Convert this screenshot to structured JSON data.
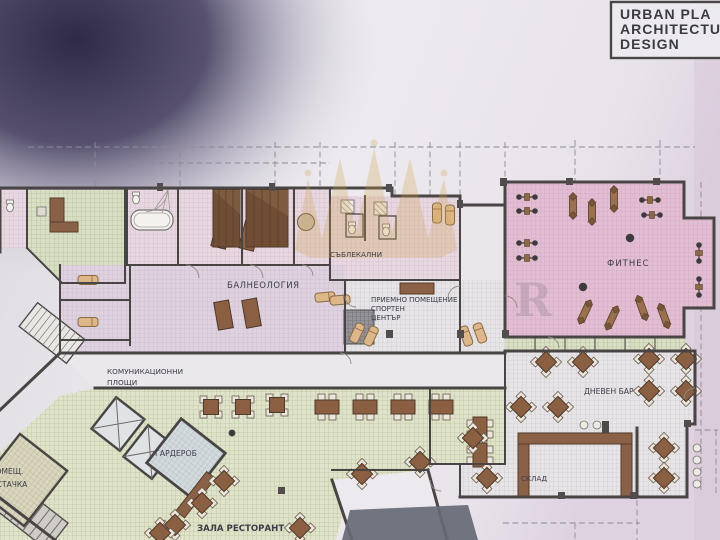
{
  "title_block": {
    "line1": "URBAN PLA",
    "line2": "ARCHITECTU",
    "line3": "DESIGN"
  },
  "rooms": {
    "balneology": "БАЛНЕОЛОГИЯ",
    "changing_rooms": "СЪБЛЕКАЛНИ",
    "reception_line1": "ПРИЕМНО ПОМЕЩЕНИЕ",
    "reception_line2": "СПОРТЕН",
    "reception_line3": "ЦЕНТЪР",
    "fitness": "ФИТНЕС",
    "communication_line1": "КОМУНИКАЦИОННИ",
    "communication_line2": "ПЛОЩИ",
    "wardrobe": "ГАРДЕРОБ",
    "cleaner_line1": "ПОМЕЩ.",
    "cleaner_line2": "ЧИСТАЧКА",
    "restaurant": "ЗАЛА РЕСТОРАНТ",
    "day_bar": "ДНЕВЕН БАР",
    "storage": "СКЛАД"
  },
  "colors": {
    "paper": "#e9e7ec",
    "corner_shadow": "#2f2a47",
    "wall": "#4a4545",
    "fitness_pink": "#e2bed3",
    "balneology_lavender": "#ded2df",
    "restaurant_green": "#dfe3c9",
    "wardrobe_blue": "#d2dade",
    "furniture_brown": "#8a5f42",
    "lounge_tan": "#ddb787",
    "axis_dash_red": "#bf6f5f",
    "watermark_gold": "#cfa14b"
  }
}
